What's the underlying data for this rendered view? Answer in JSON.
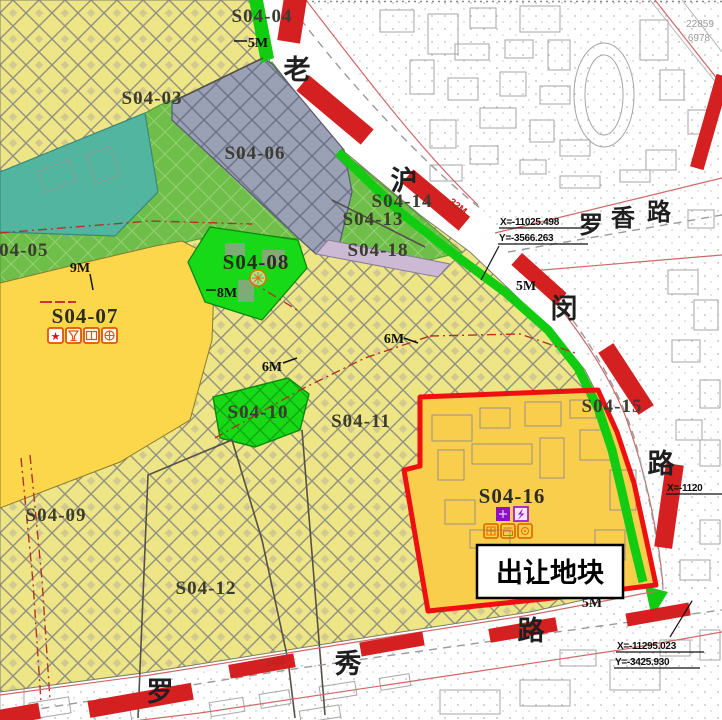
{
  "map": {
    "type": "land-use planning map",
    "export_parcel": {
      "label": "出让地块",
      "parcel_id": "S04-16"
    },
    "parcel_labels": [
      {
        "id": "s04-03",
        "text": "S04-03"
      },
      {
        "id": "s04-04",
        "text": "S04-04"
      },
      {
        "id": "s04-05",
        "text": "S04-05"
      },
      {
        "id": "s04-06",
        "text": "S04-06"
      },
      {
        "id": "s04-07",
        "text": "S04-07"
      },
      {
        "id": "s04-08",
        "text": "S04-08"
      },
      {
        "id": "s04-09",
        "text": "S04-09"
      },
      {
        "id": "s04-10",
        "text": "S04-10"
      },
      {
        "id": "s04-11",
        "text": "S04-11"
      },
      {
        "id": "s04-12",
        "text": "S04-12"
      },
      {
        "id": "s04-13",
        "text": "S04-13"
      },
      {
        "id": "s04-14",
        "text": "S04-14"
      },
      {
        "id": "s04-15",
        "text": "S04-15"
      },
      {
        "id": "s04-16",
        "text": "S04-16"
      },
      {
        "id": "s04-18",
        "text": "S04-18"
      }
    ],
    "road_names": {
      "lao_hu_min_chars": [
        "老",
        "沪",
        "闵",
        "路"
      ],
      "luo_xiang_chars": [
        "罗",
        "香",
        "路"
      ],
      "luo_xiu_chars": [
        "罗",
        "秀",
        "路"
      ]
    },
    "width_labels": [
      {
        "text": "5M"
      },
      {
        "text": "9M"
      },
      {
        "text": "8M"
      },
      {
        "text": "6M"
      },
      {
        "text": "6M"
      },
      {
        "text": "5M"
      },
      {
        "text": "5M"
      }
    ],
    "red_road_widths": [
      {
        "text": "32M"
      },
      {
        "text": "24M"
      }
    ],
    "coordinate_markers": [
      {
        "x_label": "X=-11025.498",
        "y_label": "Y=-3566.263"
      },
      {
        "x_label": "X=-11295.023",
        "y_label": "Y=-3425.930"
      },
      {
        "x_label": "X=-1120",
        "y_label": ""
      }
    ],
    "survey_numbers": [
      "22859",
      "6978"
    ],
    "icons": {
      "s04_07": [
        "red-star",
        "wine-cup",
        "book",
        "crossed-circle"
      ],
      "s04_08": [
        "flower-circle"
      ],
      "s04_16": [
        "purple-block",
        "substation-lightning",
        "window-grid",
        "shop-front",
        "meter-box"
      ]
    },
    "colors": {
      "yellow_hatch": "#EDE586",
      "bright_yellow": "#FCD74B",
      "gold": "#F9CE4D",
      "green_band": "#6FBE49",
      "teal": "#52B5A0",
      "bright_green": "#17D917",
      "gray_blue": "#9BA1B5",
      "lavender": "#CCB9D4",
      "red_bar": "#D42020",
      "red_border": "#EE1010"
    }
  }
}
